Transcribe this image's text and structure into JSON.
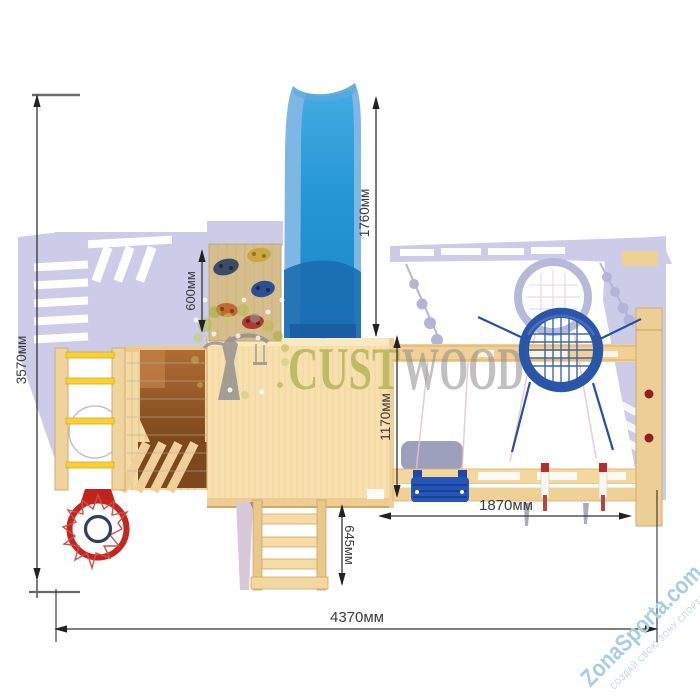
{
  "watermarks": {
    "brand": {
      "part_green": "CUST",
      "part_gray": "WOOD",
      "green_color": "#99a63a",
      "gray_color": "#8d8d8d"
    },
    "site": {
      "name": "ZonaSporta.com",
      "slogan": "СОЗДАЙ СВОЮ ЗОНУ СПОРТА",
      "color": "#a9cde2"
    }
  },
  "dimensions": {
    "depth_total": {
      "label": "3570мм"
    },
    "slide_bay": {
      "label": "1760мм"
    },
    "climb_wall": {
      "label": "600мм"
    },
    "swing_depth": {
      "label": "1170мм"
    },
    "ladder_bay": {
      "label": "645мм"
    },
    "swing_width": {
      "label": "1870мм"
    },
    "width_total": {
      "label": "4370мм"
    }
  },
  "palette": {
    "slide_blue": "#2196d6",
    "wood_light": "#f6dfab",
    "hoop_red": "#c3261f",
    "swing_navy": "#2a55a8",
    "shadow_lavender": "#cdcce8",
    "rung_yellow": "#f7d232"
  }
}
